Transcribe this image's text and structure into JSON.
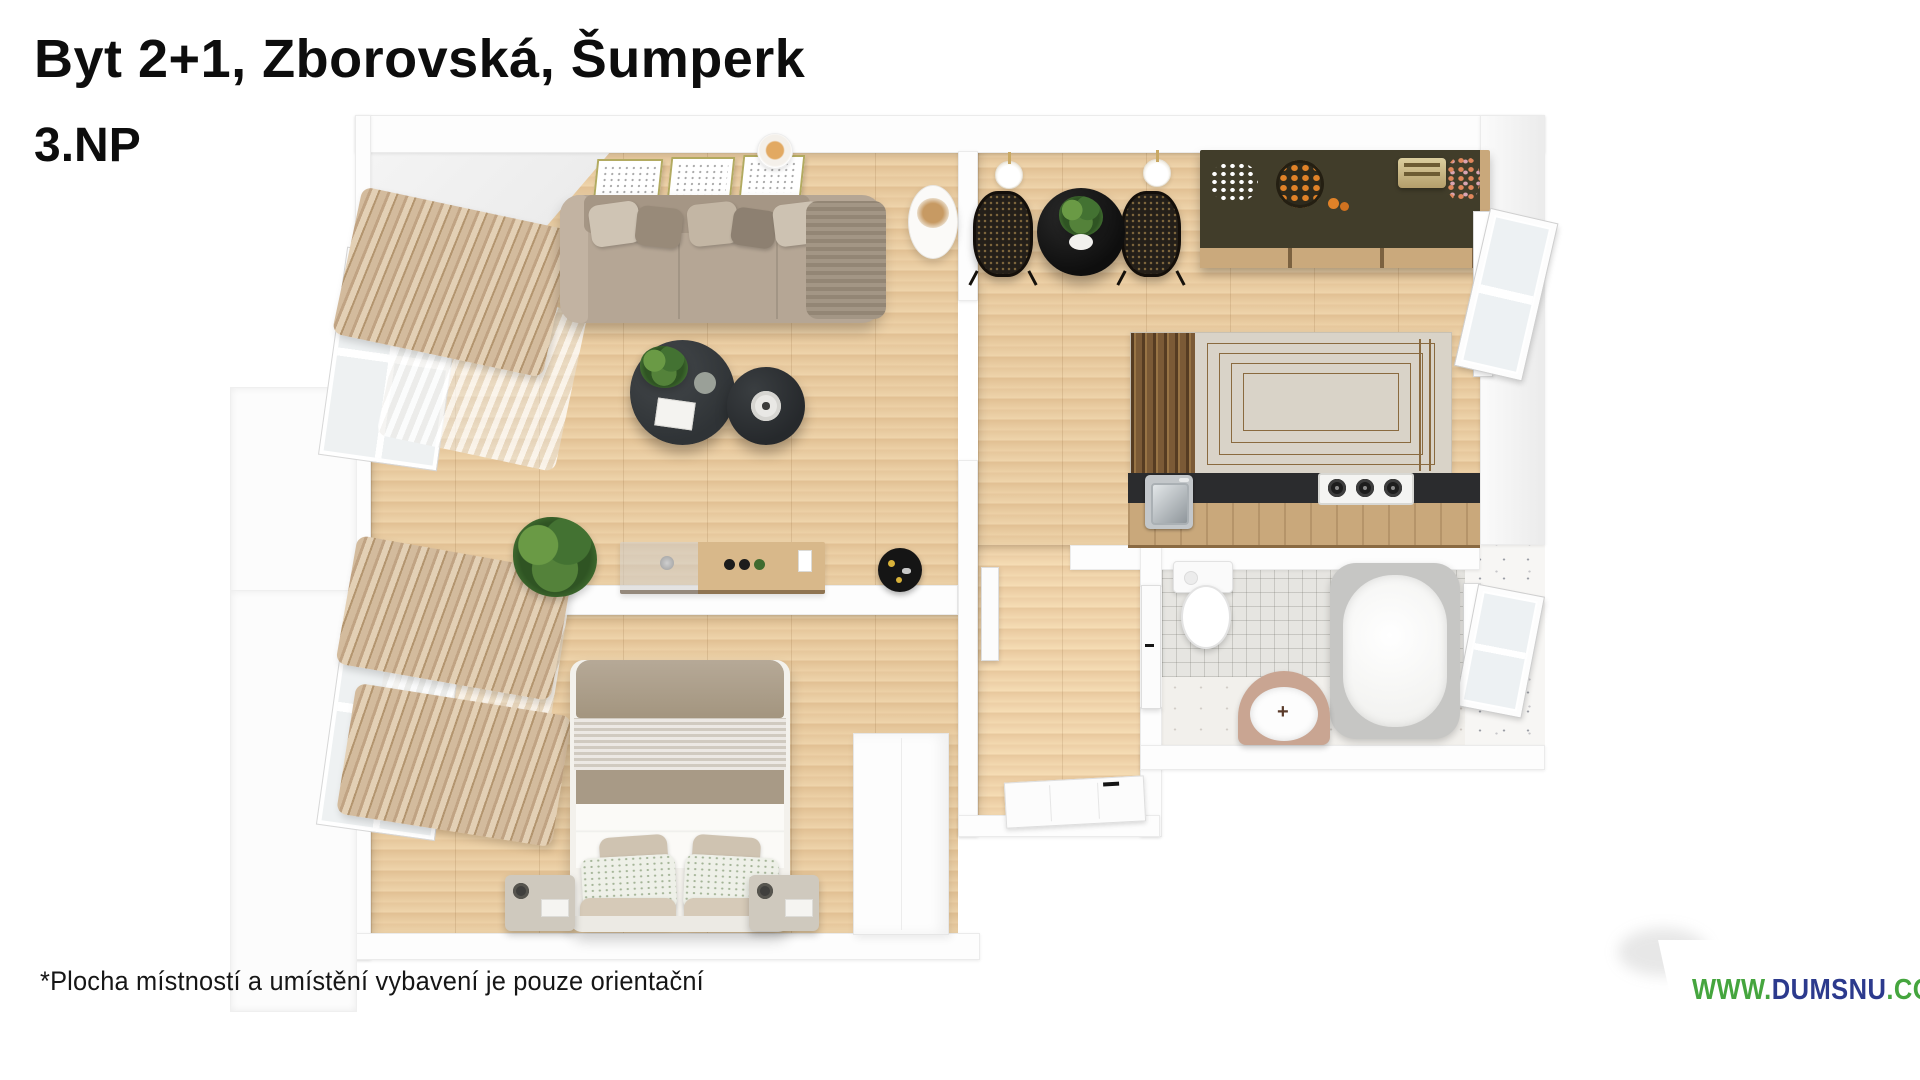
{
  "header": {
    "title": "Byt 2+1, Zborovská, Šumperk",
    "floor": "3.NP"
  },
  "footer": {
    "disclaimer": "*Plocha místností a umístění vybavení je pouze orientační"
  },
  "watermark": {
    "www": "WWW.",
    "domain": "DUMSNU",
    "tld": ".COM",
    "www_color": "#45a53e",
    "domain_color": "#2c3a8d",
    "banner_background": "#ffffff"
  },
  "floorplan": {
    "type": "3d-top-down-apartment-render",
    "rooms": [
      {
        "name": "living-room",
        "furniture": [
          "sofa-with-pillows",
          "three-picture-frames",
          "wall-candle",
          "cylinder-side-lamp",
          "round-coffee-table-large",
          "round-coffee-table-small",
          "potted-plant",
          "low-console-shelf",
          "round-black-mat",
          "window-curtains"
        ]
      },
      {
        "name": "kitchen-dining",
        "furniture": [
          "round-black-dining-table",
          "two-rattan-chairs",
          "two-wall-lamps",
          "dark-sideboard-with-decor",
          "patterned-rug",
          "kitchen-counter-with-sink-and-hob",
          "open-window"
        ]
      },
      {
        "name": "hallway",
        "furniture": [
          "entry-door",
          "bathroom-door",
          "kitchen-door"
        ]
      },
      {
        "name": "bathroom",
        "furniture": [
          "toilet",
          "freestanding-bathtub",
          "washbasin",
          "open-window"
        ]
      },
      {
        "name": "bedroom",
        "furniture": [
          "double-bed-with-pillows",
          "nightstand-left",
          "nightstand-right",
          "wardrobe",
          "window-curtains"
        ]
      }
    ],
    "palette": {
      "wood_floor": "#e8cba1",
      "walls": "#fdfdfd",
      "sofa": "#b5a695",
      "tables_dark": "#2f3336",
      "rug_field": "#d9d3c8",
      "rug_band": "#7b5a36",
      "counter_top": "#2b2c2e",
      "counter_wood": "#c9a87b",
      "curtains": "#d3bb9d",
      "tiles": "#e6e5e1"
    }
  }
}
